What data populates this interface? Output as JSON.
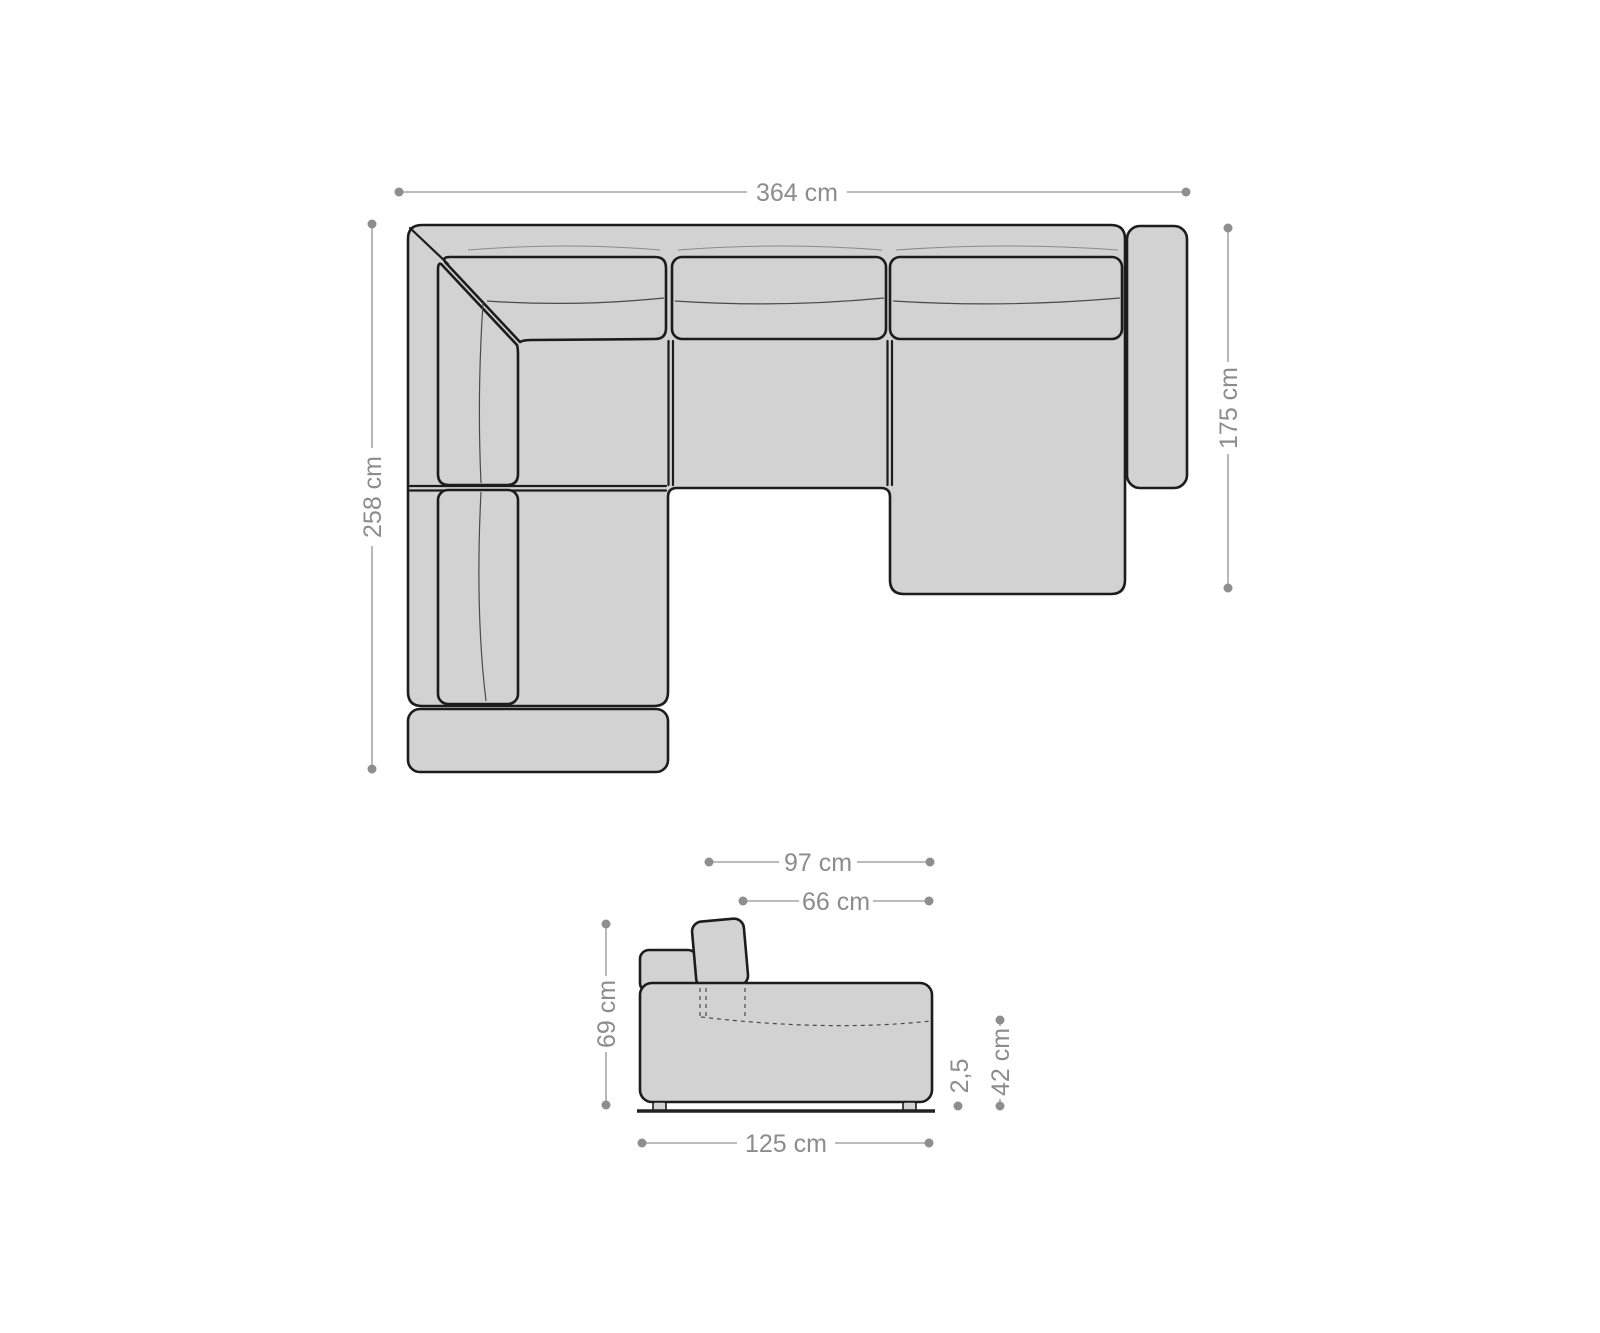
{
  "meta": {
    "description": "Sofa dimension diagram with top view and side view"
  },
  "top_view": {
    "overall_width": "364 cm",
    "left_depth": "258 cm",
    "right_depth": "175 cm"
  },
  "side_view": {
    "total_depth": "97 cm",
    "seat_depth": "66 cm",
    "back_height": "69 cm",
    "base_depth": "125 cm",
    "foot_height": "2,5",
    "seat_height": "42 cm"
  },
  "colors": {
    "sofa_fill": "#d2d2d2",
    "outline": "#1c1c1c",
    "dimension_line": "#a6a6a6",
    "dimension_dot": "#8e8e8e",
    "dimension_text": "#8c8c8c",
    "floor": "#222222",
    "bg": "#ffffff"
  }
}
